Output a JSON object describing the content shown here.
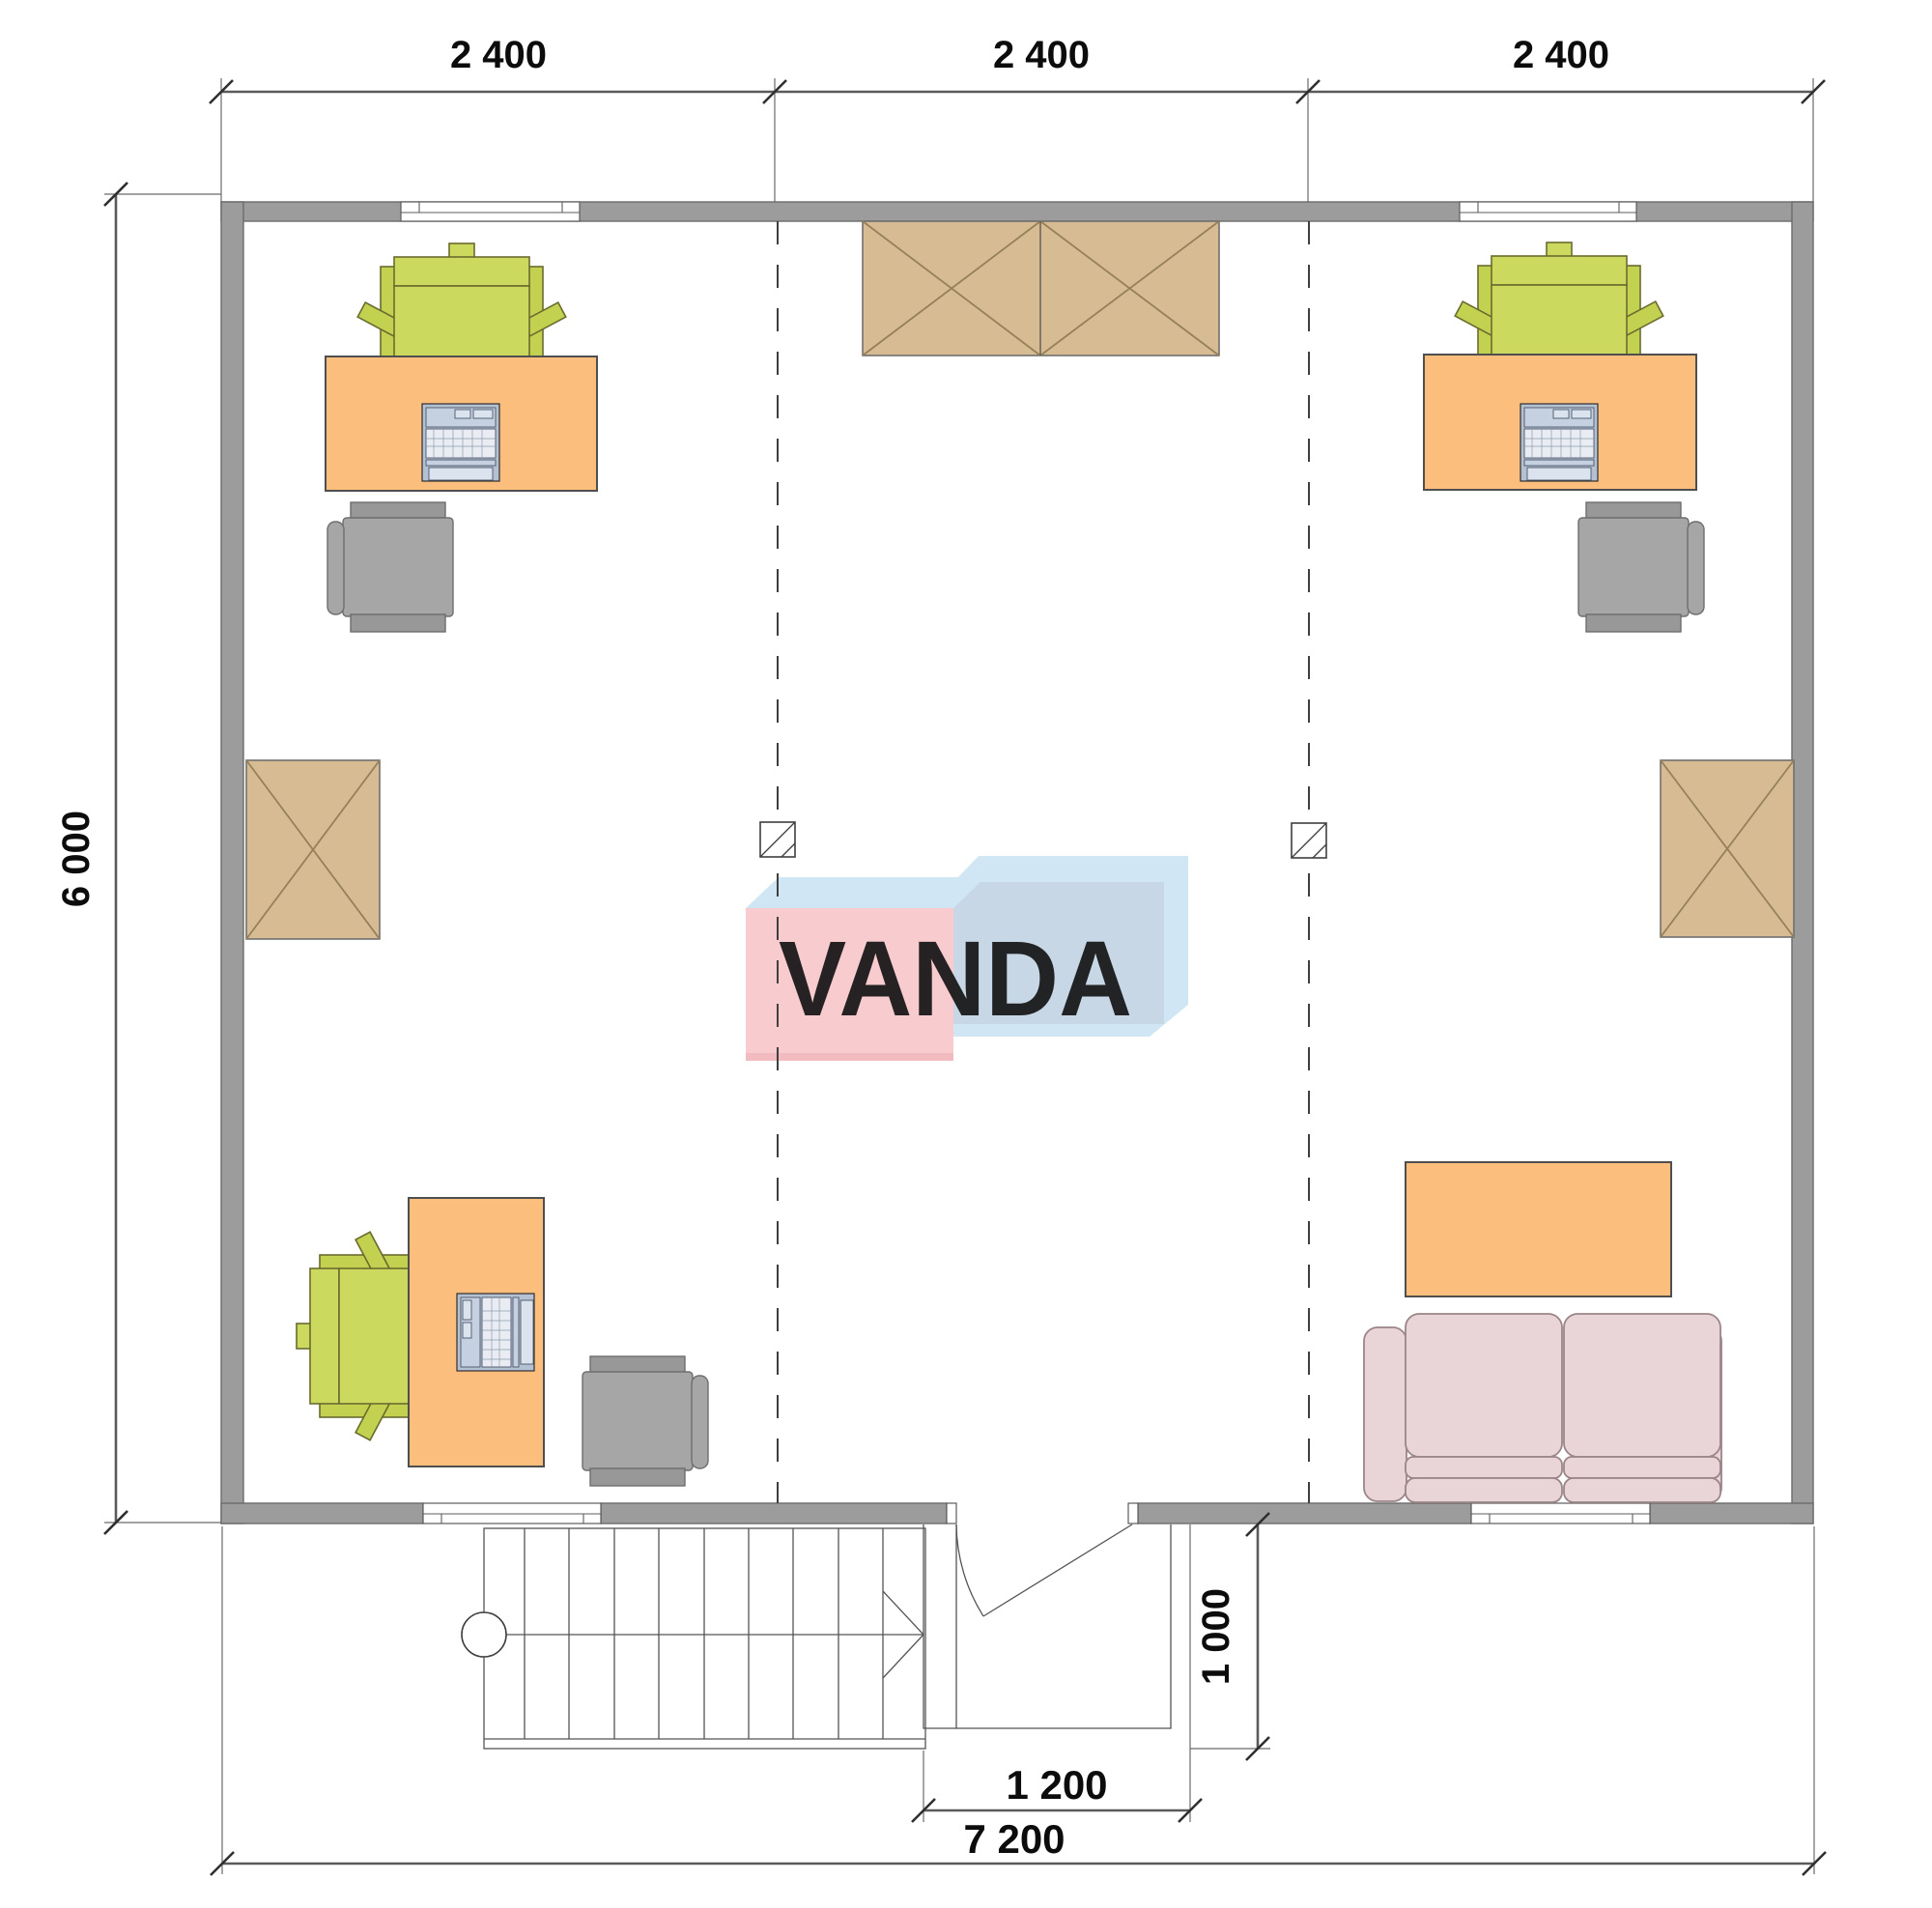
{
  "watermark": {
    "text": "VANDA"
  },
  "dimensions": {
    "top_segments": [
      "2 400",
      "2 400",
      "2 400"
    ],
    "side_height": "6 000",
    "entry_width": "1 200",
    "porch_depth": "1 000",
    "total_width": "7 200"
  },
  "colors": {
    "wall": "#9c9c9c",
    "desk_orange": "#fbbe7d",
    "chair_green": "#ccd95f",
    "chair_gray": "#a6a6a6",
    "wardrobe_tan": "#d6bb93",
    "sofa_pink": "#e9d4d8",
    "laptop_blue": "#b3c1d3",
    "logo_pink": "#f8c9cd",
    "logo_blue_front": "#c5d6e6",
    "logo_blue_top": "#cfe6f4"
  }
}
